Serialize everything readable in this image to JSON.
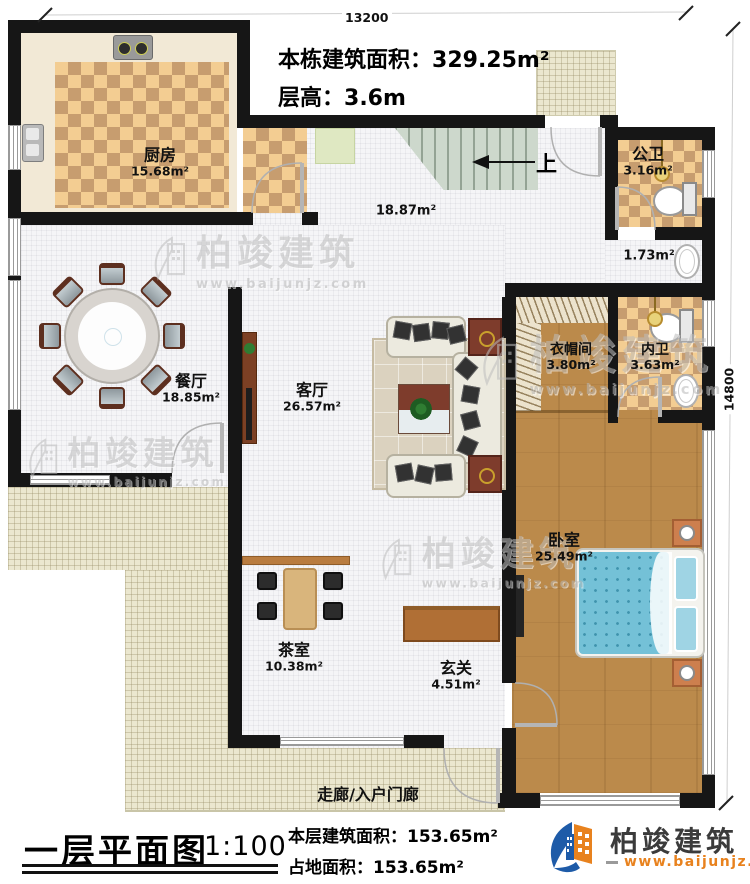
{
  "dimensions": {
    "top": "13200",
    "right": "14800"
  },
  "header": {
    "building_area_label": "本栋建筑面积：",
    "building_area_value": "329.25m²",
    "floor_height_label": "层高：",
    "floor_height_value": "3.6m"
  },
  "rooms": {
    "kitchen": {
      "name": "厨房",
      "area": "15.68m²"
    },
    "public_bath": {
      "name": "公卫",
      "area": "3.16m²"
    },
    "hall": {
      "area": "18.87m²"
    },
    "wash_corridor": {
      "area": "1.73m²"
    },
    "dining": {
      "name": "餐厅",
      "area": "18.85m²"
    },
    "living": {
      "name": "客厅",
      "area": "26.57m²"
    },
    "cloakroom": {
      "name": "衣帽间",
      "area": "3.80m²"
    },
    "ensuite_bath": {
      "name": "内卫",
      "area": "3.63m²"
    },
    "bedroom": {
      "name": "卧室",
      "area": "25.49m²"
    },
    "tea_room": {
      "name": "茶室",
      "area": "10.38m²"
    },
    "foyer": {
      "name": "玄关",
      "area": "4.51m²"
    },
    "entrance_porch": {
      "name": "走廊/入户门廊"
    }
  },
  "stairs": {
    "direction_label": "上"
  },
  "footer": {
    "plan_title": "一层平面图",
    "scale": "1:100",
    "floor_area_label": "本层建筑面积：",
    "floor_area_value": "153.65m²",
    "land_area_label": "占地面积：",
    "land_area_value": "153.65m²"
  },
  "brand": {
    "name": "柏竣建筑",
    "website": "www.baijunjz.com"
  },
  "watermark": {
    "name": "柏竣建筑",
    "website": "www.baijunjz.com"
  },
  "colors": {
    "wall": "#161616",
    "brand_blue": "#1e5ba8",
    "brand_orange": "#e8821e",
    "wood_floor": "#bb8a4b",
    "tile_accent": "#c79d6f",
    "bed": "#74c1d7",
    "stairs": "#cdd8cc"
  }
}
